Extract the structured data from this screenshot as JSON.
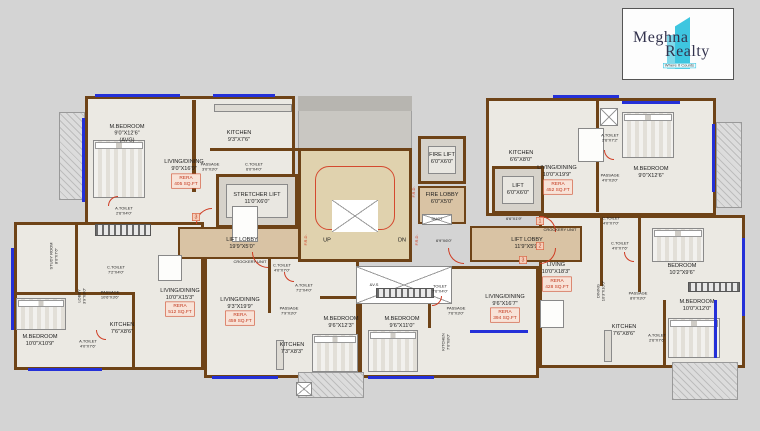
{
  "logo": {
    "brand_line1": "Meghna",
    "brand_line2": "Realty",
    "tagline": "Where It Counts"
  },
  "colors": {
    "accent_cyan": "#3ec6e0",
    "wall_brown": "#6e4317",
    "lobby_tan": "#d9c3a4",
    "rera_red": "#c2371c",
    "window_blue": "#2430d8",
    "door_red": "#cf3b22"
  },
  "core": {
    "stretcher_lift": {
      "name": "STRETCHER LIFT",
      "dims": "11'0\"X6'0\""
    },
    "lift_lobby_left": {
      "name": "LIFT LOBBY",
      "dims": "19'9\"X5'0\""
    },
    "lift_lobby_right": {
      "name": "LIFT LOBBY",
      "dims": "11'9\"X5'9\""
    },
    "fire_lift": {
      "name": "FIRE LIFT",
      "dims": "6'0\"X6'0\""
    },
    "fire_lobby": {
      "name": "FIRE LOBBY",
      "dims": "6'0\"X5'0\""
    },
    "lift": {
      "name": "LIFT",
      "dims": "6'0\"X6'0\""
    },
    "stair_up": "UP",
    "stair_dn": "DN",
    "frd": "F.R.D.",
    "duct": "DUCT",
    "vent_shaft": "&V.S",
    "crockery_unit": "CROCKERY UNIT",
    "dim_beside_stair": "6'9\"X6'0\"",
    "dim_beside_lift": "6'6\"X1'9\""
  },
  "units": {
    "top_left": {
      "m_bedroom": {
        "name": "M.BEDROOM",
        "dims": "9'0\"X12'6\"",
        "note": "(AVG)"
      },
      "living_dining": {
        "name": "LIVING/DINING",
        "dims": "9'0\"X16'9\""
      },
      "rera": {
        "label": "RERA",
        "area": "405 SQ.FT"
      },
      "kitchen": {
        "name": "KITCHEN",
        "dims": "9'3\"X7'6\""
      },
      "passage": {
        "name": "PASSAGE",
        "dims": "3'0\"X3'0\""
      },
      "c_toilet": {
        "name": "C.TOILET",
        "dims": "6'0\"X4'0\""
      },
      "a_toilet": {
        "name": "A.TOILET",
        "dims": "2'6\"X4'0\""
      }
    },
    "top_right": {
      "kitchen": {
        "name": "KITCHEN",
        "dims": "6'6\"X8'0\""
      },
      "living_dining": {
        "name": "LIVING/DINING",
        "dims": "10'0\"X19'9\""
      },
      "rera": {
        "label": "RERA",
        "area": "452 SQ.FT"
      },
      "a_toilet": {
        "name": "A.TOILET",
        "dims": "2'6\"X7'2\""
      },
      "passage": {
        "name": "PASSAGE",
        "dims": "4'0\"X3'0\""
      },
      "m_bedroom": {
        "name": "M.BEDROOM",
        "dims": "9'0\"X12'6\""
      },
      "c_toilet": {
        "name": "C.TOILET",
        "dims": "4'0\"X7'0\""
      }
    },
    "right": {
      "living": {
        "name": "LIVING",
        "dims": "10'0\"X18'3\""
      },
      "rera": {
        "label": "RERA",
        "area": "428 SQ.FT"
      },
      "dining": {
        "name": "DINING",
        "dims": "10'3\"X10'0\""
      },
      "bedroom": {
        "name": "BEDROOM",
        "dims": "10'2\"X9'6\""
      },
      "c_toilet": {
        "name": "C.TOILET",
        "dims": "4'0\"X7'6\""
      },
      "passage": {
        "name": "PASSAGE",
        "dims": "8'0\"X3'0\""
      },
      "m_bedroom": {
        "name": "M.BEDROOM",
        "dims": "10'0\"X12'0\""
      },
      "kitchen": {
        "name": "KITCHEN",
        "dims": "7'6\"X8'6\""
      },
      "a_toilet": {
        "name": "A.TOILET",
        "dims": "2'6\"X7'6\""
      }
    },
    "bottom_mid_right": {
      "living_dining": {
        "name": "LIVING/DINING",
        "dims": "9'6\"X16'7\""
      },
      "rera": {
        "label": "RERA",
        "area": "394 SQ.FT"
      },
      "m_bedroom": {
        "name": "M.BEDROOM",
        "dims": "9'6\"X11'0\""
      },
      "toilet": {
        "name": "TOILET",
        "dims": "7'6\"X4'0\""
      },
      "passage": {
        "name": "PASSAGE",
        "dims": "7'6\"X3'0\""
      },
      "kitchen": {
        "name": "KITCHEN",
        "dims": "7'0\"X8'0\""
      }
    },
    "bottom_mid_left": {
      "living_dining": {
        "name": "LIVING/DINING",
        "dims": "9'3\"X19'9\""
      },
      "rera": {
        "label": "RERA",
        "area": "459 SQ.FT"
      },
      "m_bedroom": {
        "name": "M.BEDROOM",
        "dims": "9'6\"X12'3\""
      },
      "c_toilet": {
        "name": "C.TOILET",
        "dims": "4'0\"X7'0\""
      },
      "a_toilet": {
        "name": "A.TOILET",
        "dims": "7'2\"X4'0\""
      },
      "passage": {
        "name": "PASSAGE",
        "dims": "7'9\"X3'0\""
      },
      "kitchen": {
        "name": "KITCHEN",
        "dims": "7'3\"X8'3\""
      }
    },
    "bottom_left": {
      "m_bedroom": {
        "name": "M.BEDROOM",
        "dims": "10'0\"X10'9\""
      },
      "study": {
        "name": "STUDY ROOM",
        "dims": "8'0\"X7'6\""
      },
      "lobby": {
        "name": "LOBBY",
        "dims": "3'9\"X3'0\""
      },
      "passage": {
        "name": "PASSAGE",
        "dims": "10'6\"X3'6\""
      },
      "living_dining": {
        "name": "LIVING/DINING",
        "dims": "10'0\"X15'3\""
      },
      "rera": {
        "label": "RERA",
        "area": "512 SQ.FT"
      },
      "a_toilet": {
        "name": "A.TOILET",
        "dims": "4'0\"X7'6\""
      },
      "kitchen": {
        "name": "KITCHEN",
        "dims": "7'6\"X8'6\""
      },
      "c_toilet": {
        "name": "C.TOILET",
        "dims": "7'2\"X4'0\""
      }
    }
  },
  "markers": {
    "left": "3",
    "right_1": "1",
    "right_2": "2",
    "right_3": "3"
  }
}
